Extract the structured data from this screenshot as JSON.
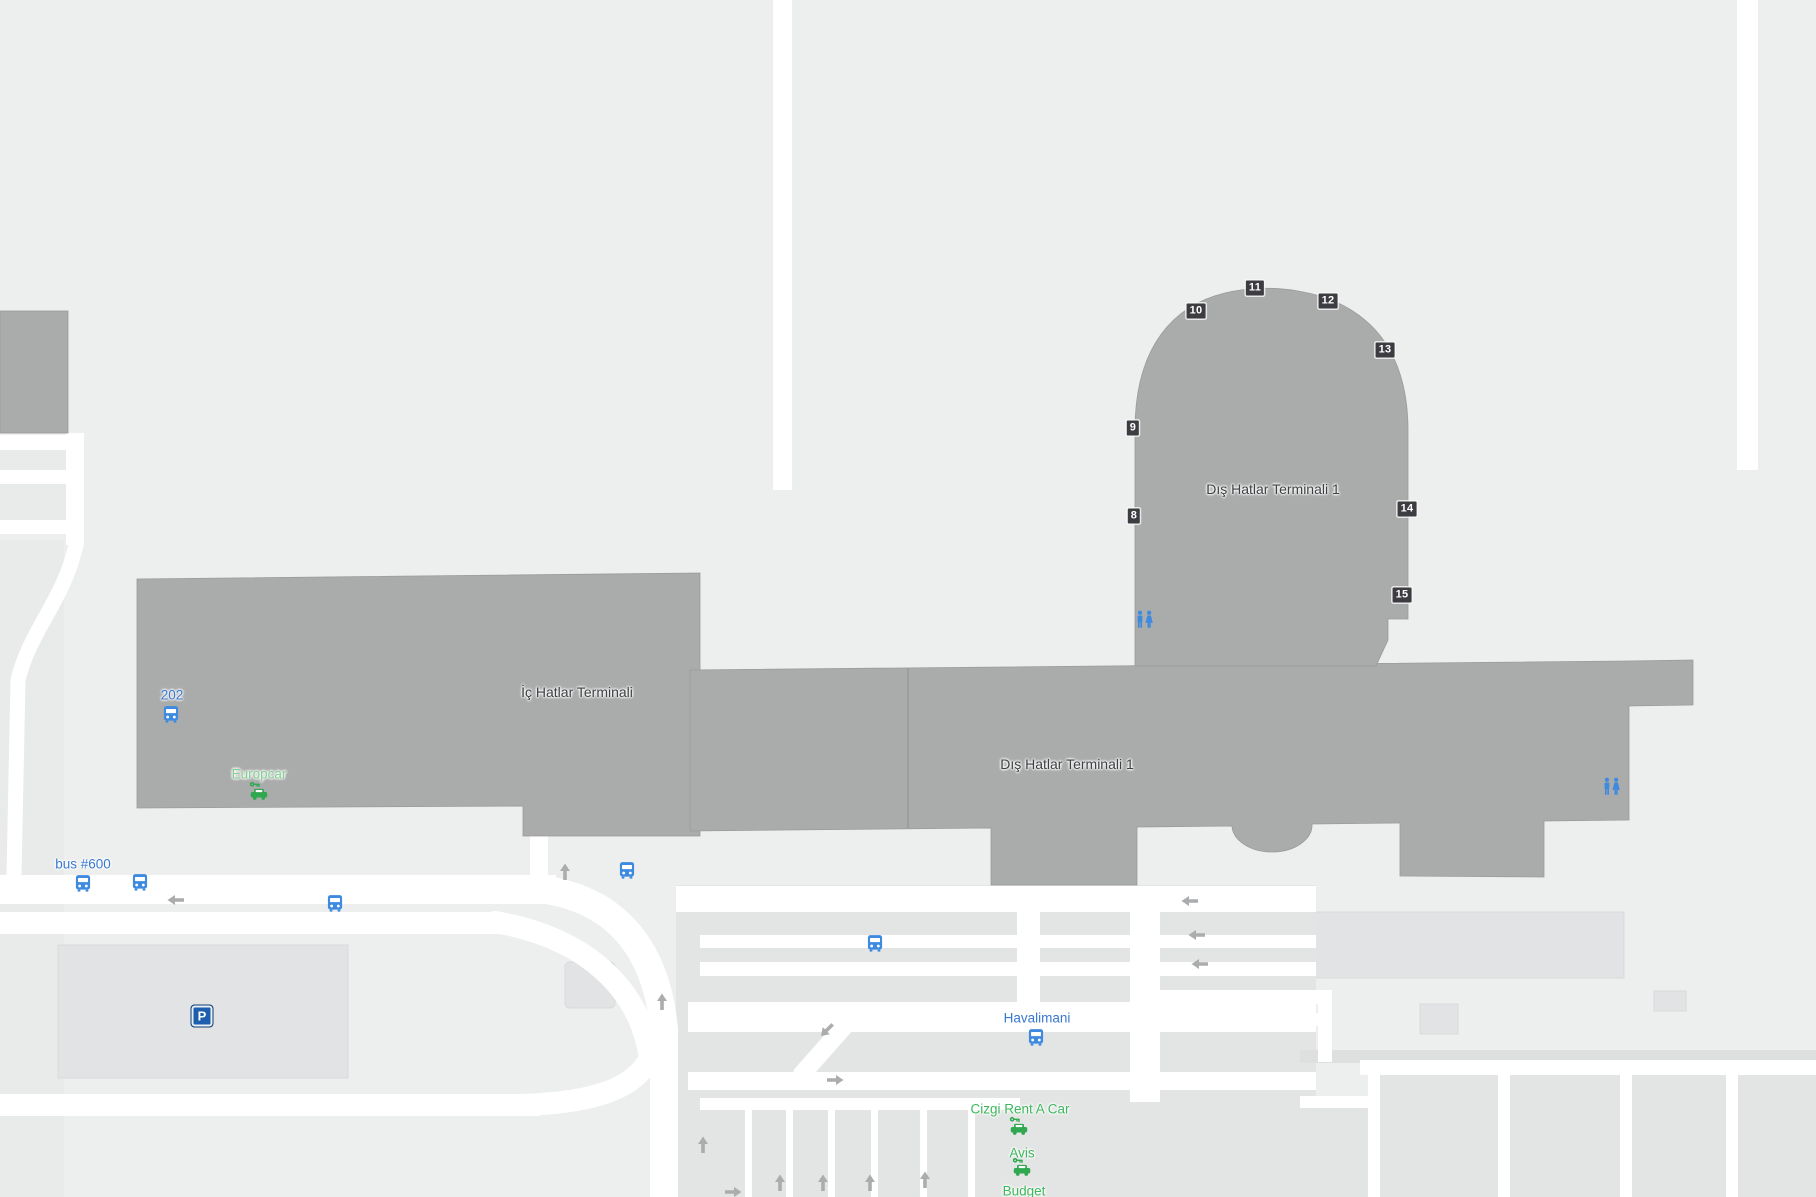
{
  "colors": {
    "bg": "#EDEEEE",
    "zone": "#E9EAEA",
    "zone_strong": "#E2E3E4",
    "zone_stroke": "#D9DADB",
    "row": "#E3E4E4",
    "band": "#DEDFDF",
    "road": "#FFFFFF",
    "building": "#AAABAB",
    "building_stroke": "#9A9B9B",
    "terminal_text": "#3E4043",
    "transit_blue": "#3D8AE0",
    "label_blue": "#3A79D1",
    "rental_green": "#2FA84F",
    "label_green": "#3CB85C",
    "europcar_green": "#84CE94",
    "gate_bg": "#3D3D41",
    "parking_blue": "#1D5FAE",
    "arrow_gray": "#ABACAE"
  },
  "terminals": [
    {
      "label": "Dış Hatlar Terminali 1"
    },
    {
      "label": "İç Hatlar Terminali"
    },
    {
      "label": "Dış Hatlar Terminali 1"
    }
  ],
  "gates": [
    "8",
    "9",
    "10",
    "11",
    "12",
    "13",
    "14",
    "15"
  ],
  "transit": {
    "stops": [
      {
        "label": "202"
      },
      {
        "label": "bus #600"
      },
      {
        "label": "Havalimani"
      }
    ]
  },
  "rentals": [
    {
      "label": "Europcar"
    },
    {
      "label": "Cizgi Rent A Car"
    },
    {
      "label": "Avis"
    },
    {
      "label": "Budget"
    }
  ],
  "parking": {
    "label": "P"
  },
  "icons": {
    "bus": "bus-stop-icon",
    "restroom": "restroom-icon",
    "car_rental": "car-rental-icon",
    "parking": "parking-icon",
    "arrow": "direction-arrow-icon"
  }
}
